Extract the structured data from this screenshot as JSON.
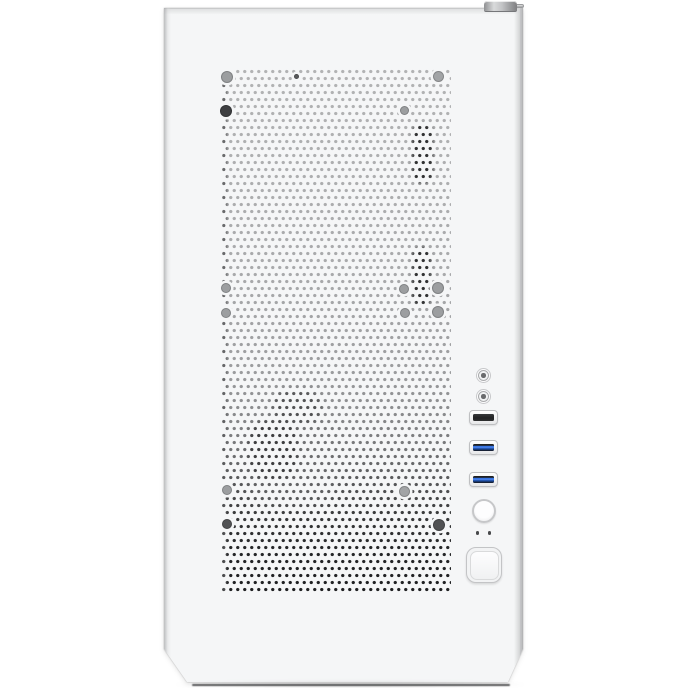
{
  "meta": {
    "type": "product-photo",
    "subject": "White mini tower PC case, front view with perforated mesh panel",
    "canvas": {
      "width": 688,
      "height": 688
    }
  },
  "colors": {
    "page-bg": "#ffffff",
    "panel": "#f5f6f7",
    "panel-edge": "#c6c7c9",
    "bezel-border": "#bebfc1",
    "port-dark": "#28292a",
    "usb-blue": "#2f6fe0",
    "led-dot": "#48494b",
    "knob-gray": "#aeafb1",
    "mesh-backdrop-top": "#b2b3b4",
    "mesh-backdrop-bottom": "#1f2022",
    "screw-gray": "#9c9ea0",
    "screw-dark": "#515254"
  },
  "case_front": {
    "label": "pc case front panel",
    "mesh_label": "perforated mesh air intake",
    "top_edge_label": "case top edge",
    "thumbscrew_label": "top panel thumbscrew"
  },
  "front_io": {
    "audio_jack_1_label": "microphone jack",
    "audio_jack_2_label": "headphone jack",
    "usb2_label": "usb 2.0 port",
    "usb3_1_label": "usb 3.0 port",
    "usb3_2_label": "usb 3.0 port",
    "reset_button_label": "reset button",
    "led_1_label": "power led",
    "led_2_label": "hdd led",
    "power_button_label": "power button"
  },
  "mesh": {
    "screws": [
      {
        "cx": 5,
        "cy": 9,
        "d": 12,
        "color": "#9c9ea0"
      },
      {
        "cx": 216,
        "cy": 8,
        "d": 11,
        "color": "#a2a4a6"
      },
      {
        "cx": 74,
        "cy": 8,
        "d": 5,
        "color": "#5a5b5d"
      },
      {
        "cx": 4,
        "cy": 43,
        "d": 12,
        "color": "#3e3f41"
      },
      {
        "cx": 182,
        "cy": 42,
        "d": 9,
        "color": "#9c9ea0"
      },
      {
        "cx": 4,
        "cy": 220,
        "d": 10,
        "color": "#9c9ea0"
      },
      {
        "cx": 4,
        "cy": 245,
        "d": 10,
        "color": "#9c9ea0"
      },
      {
        "cx": 182,
        "cy": 221,
        "d": 10,
        "color": "#9c9ea0"
      },
      {
        "cx": 216,
        "cy": 220,
        "d": 12,
        "color": "#9c9ea0"
      },
      {
        "cx": 183,
        "cy": 245,
        "d": 10,
        "color": "#9c9ea0"
      },
      {
        "cx": 216,
        "cy": 244,
        "d": 12,
        "color": "#9c9ea0"
      },
      {
        "cx": 5,
        "cy": 422,
        "d": 10,
        "color": "#9c9ea0"
      },
      {
        "cx": 182,
        "cy": 423,
        "d": 11,
        "color": "#a2a4a6"
      },
      {
        "cx": 5,
        "cy": 456,
        "d": 10,
        "color": "#515254"
      },
      {
        "cx": 217,
        "cy": 457,
        "d": 12,
        "color": "#515254"
      }
    ],
    "shadows": [
      {
        "x": 0,
        "y": 0,
        "w": 5,
        "h": 524,
        "color": "#58595b",
        "opacity": 0.85,
        "blur": 1,
        "radius": 0
      },
      {
        "x": 190,
        "y": 56,
        "w": 21,
        "h": 59,
        "color": "#2b2c2d",
        "opacity": 0.95,
        "blur": 1.5,
        "radius": 9
      },
      {
        "x": 190,
        "y": 179,
        "w": 19,
        "h": 59,
        "color": "#2b2c2d",
        "opacity": 0.95,
        "blur": 1.5,
        "radius": 9
      },
      {
        "x": 24,
        "y": 350,
        "w": 92,
        "h": 88,
        "color": "#6f7072",
        "opacity": 0.55,
        "blur": 6,
        "radius": 24
      },
      {
        "x": 50,
        "y": 322,
        "w": 50,
        "h": 34,
        "color": "#4c4d4e",
        "opacity": 0.9,
        "blur": 3,
        "radius": 16
      },
      {
        "x": 26,
        "y": 352,
        "w": 50,
        "h": 60,
        "color": "#39393b",
        "opacity": 0.9,
        "blur": 3,
        "radius": 20
      }
    ]
  }
}
